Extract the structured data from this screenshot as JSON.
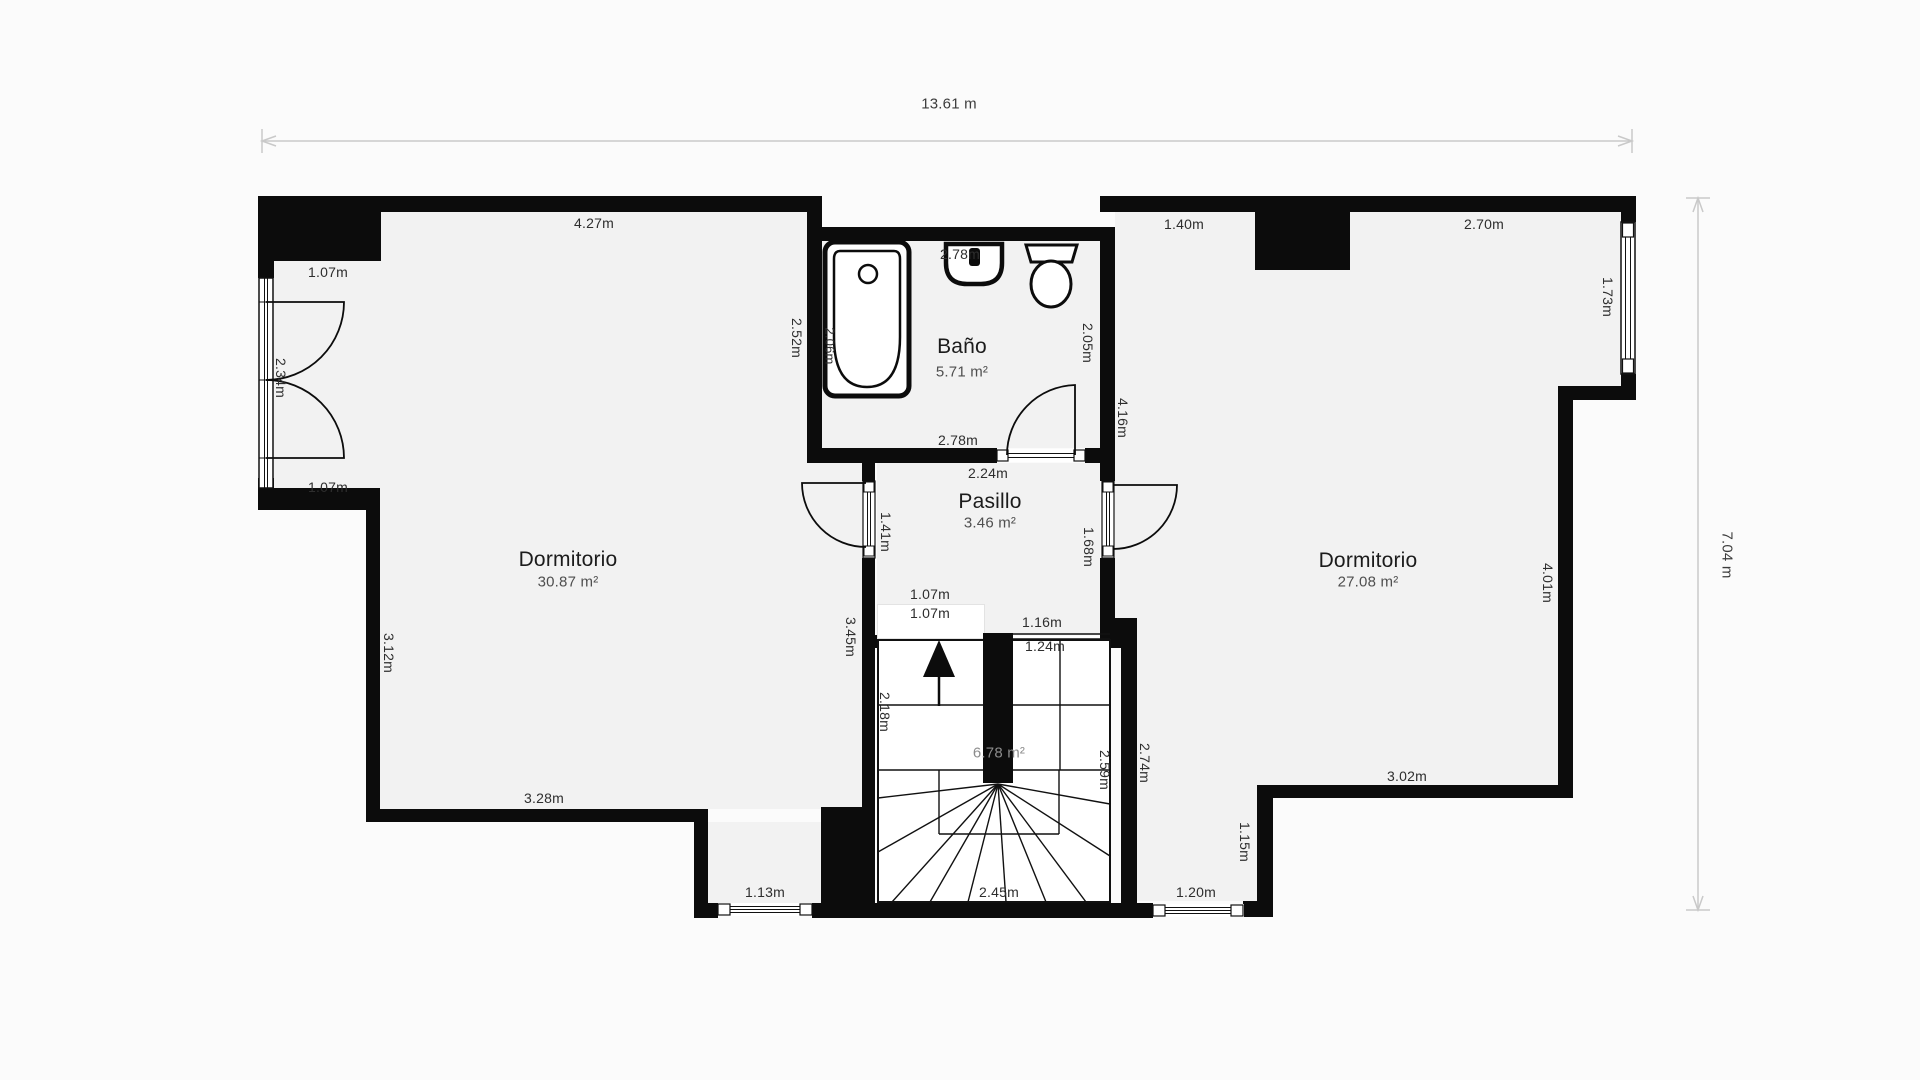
{
  "colors": {
    "wall": "#0c0c0c",
    "floor": "#f2f2f2",
    "background": "#fbfbfb",
    "dimension_line": "#c9c9c9",
    "measurement_text": "#2e2e2e",
    "room_name_text": "#1c1c1c",
    "room_area_text": "#4f4f4f",
    "stair_area_text": "#8c8c8c"
  },
  "overall_dimensions": {
    "width": "13.61 m",
    "height": "7.04 m"
  },
  "rooms": {
    "dormitorio_left": {
      "name": "Dormitorio",
      "area": "30.87 m²"
    },
    "bano": {
      "name": "Baño",
      "area": "5.71 m²"
    },
    "pasillo": {
      "name": "Pasillo",
      "area": "3.46 m²"
    },
    "dormitorio_right": {
      "name": "Dormitorio",
      "area": "27.08 m²"
    },
    "escalera": {
      "area": "6.78 m²"
    }
  },
  "measurements": {
    "top_left_wall": "4.27m",
    "left_window_top": "1.07m",
    "bath_top": "2.78m",
    "right_top_left": "1.40m",
    "right_top_right": "2.70m",
    "right_window": "1.73m",
    "left_bedroom_east": "2.52m",
    "tub_length": "2.06m",
    "left_door": "2.34m",
    "bath_right": "2.05m",
    "bedroom_right_west": "4.16m",
    "bath_bottom": "2.78m",
    "pasillo_top": "2.24m",
    "pasillo_door_left": "1.41m",
    "pasillo_door_right": "1.68m",
    "left_window_bottom": "1.07m",
    "left_wall_lower": "3.12m",
    "pasillo_west_wall": "3.45m",
    "stair_entry_a": "1.07m",
    "stair_entry_b": "1.07m",
    "stair_top_a": "1.16m",
    "stair_top_b": "1.24m",
    "stair_left": "2.18m",
    "stair_right_inner": "2.59m",
    "stair_right_outer": "2.74m",
    "bedroom_right_east": "4.01m",
    "bedroom_right_bottom": "3.02m",
    "left_bedroom_bottom": "3.28m",
    "bottom_door_left": "1.13m",
    "stair_bottom": "2.45m",
    "bottom_door_right": "1.20m",
    "bottom_step_right": "1.15m"
  }
}
